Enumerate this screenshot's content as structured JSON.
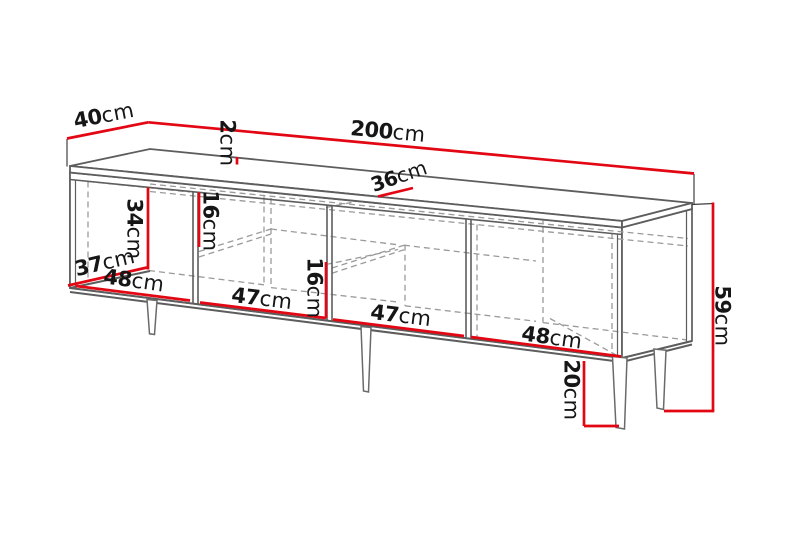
{
  "diagram": {
    "subject": "tv-stand-dimension-drawing",
    "colors": {
      "dimension_red": "#e30613",
      "outline_gray": "#5d5d5d",
      "hidden_dash_gray": "#9a9a9a",
      "label_text": "#161616",
      "background": "#ffffff"
    },
    "dimensions": [
      {
        "id": "top-depth",
        "num": "40",
        "unit": "cm"
      },
      {
        "id": "total-width",
        "num": "200",
        "unit": "cm"
      },
      {
        "id": "top-thickness",
        "num": "2",
        "unit": "cm"
      },
      {
        "id": "inner-depth-top",
        "num": "36",
        "unit": "cm"
      },
      {
        "id": "shelf-gap-upper",
        "num": "16",
        "unit": "cm"
      },
      {
        "id": "inner-height-left",
        "num": "34",
        "unit": "cm"
      },
      {
        "id": "shelf-gap-lower",
        "num": "16",
        "unit": "cm"
      },
      {
        "id": "inner-depth-left",
        "num": "37",
        "unit": "cm"
      },
      {
        "id": "compartment-1-width",
        "num": "48",
        "unit": "cm"
      },
      {
        "id": "compartment-2-width",
        "num": "47",
        "unit": "cm"
      },
      {
        "id": "compartment-3-width",
        "num": "47",
        "unit": "cm"
      },
      {
        "id": "compartment-4-width",
        "num": "48",
        "unit": "cm"
      },
      {
        "id": "total-height",
        "num": "59",
        "unit": "cm"
      },
      {
        "id": "leg-height",
        "num": "20",
        "unit": "cm"
      }
    ]
  }
}
